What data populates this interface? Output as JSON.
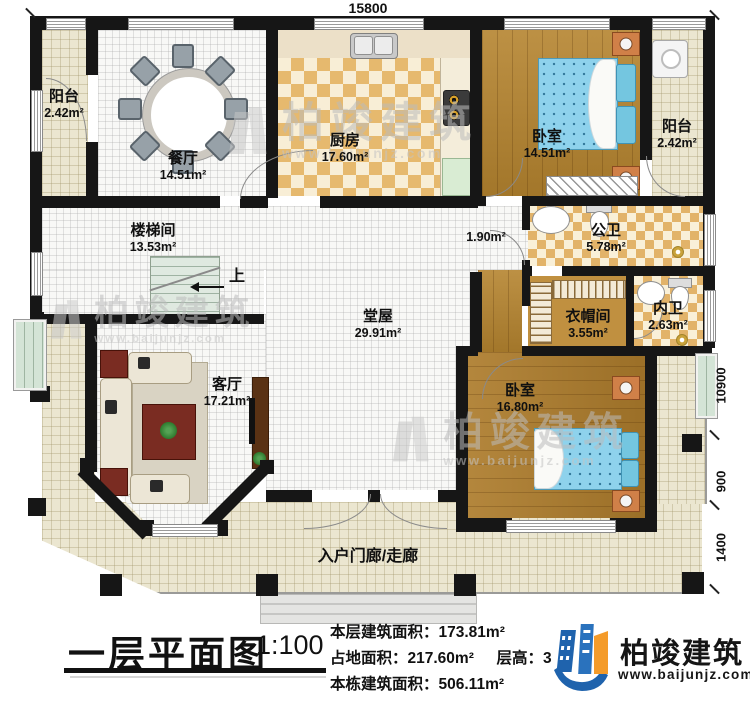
{
  "plan": {
    "dimensions": {
      "top_width": "15800",
      "right_height": "10900",
      "right_upper": "900",
      "right_lower": "1400"
    },
    "rooms": {
      "balcony_tl": {
        "name": "阳台",
        "area": "2.42m²"
      },
      "dining": {
        "name": "餐厅",
        "area": "14.51m²"
      },
      "kitchen": {
        "name": "厨房",
        "area": "17.60m²"
      },
      "bedroom1": {
        "name": "卧室",
        "area": "14.51m²"
      },
      "balcony_tr": {
        "name": "阳台",
        "area": "2.42m²"
      },
      "passage": {
        "area": "1.90m²"
      },
      "public_bath": {
        "name": "公卫",
        "area": "5.78m²"
      },
      "closet": {
        "name": "衣帽间",
        "area": "3.55m²"
      },
      "inner_bath": {
        "name": "内卫",
        "area": "2.63m²"
      },
      "bedroom2": {
        "name": "卧室",
        "area": "16.80m²"
      },
      "stairwell": {
        "name": "楼梯间",
        "area": "13.53m²"
      },
      "hall": {
        "name": "堂屋",
        "area": "29.91m²"
      },
      "living": {
        "name": "客厅",
        "area": "17.21m²"
      },
      "porch": {
        "name": "入户门廊/走廊"
      }
    },
    "stairs_up_label": "上"
  },
  "watermark": {
    "name": "柏竣建筑",
    "url": "www.baijunjz.com"
  },
  "title_bar": {
    "title": "一层平面图",
    "scale": "1:100",
    "stats": [
      {
        "label": "本层建筑面积：",
        "value": "173.81m²"
      },
      {
        "label": "占地面积：",
        "value": "217.60m²"
      },
      {
        "label": "层高：",
        "value": "3"
      },
      {
        "label": "本栋建筑面积：",
        "value": "506.11m²"
      }
    ],
    "brand": {
      "name": "柏竣建筑",
      "url": "www.baijunjz.com"
    }
  },
  "colors": {
    "wall": "#161616",
    "brand_blue": "#1f63ad",
    "brand_orange": "#f49b2a",
    "bed_blue": "#8ed2ec",
    "wood": "#b5842f",
    "porch_beige": "#ebe6d0"
  }
}
